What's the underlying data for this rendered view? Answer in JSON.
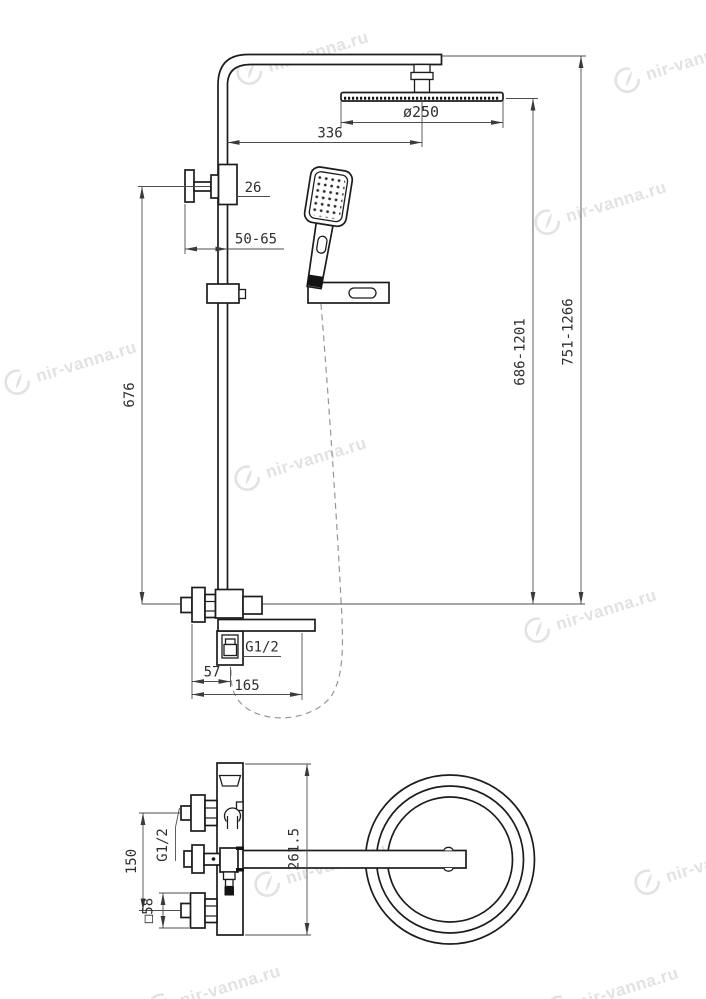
{
  "drawing": {
    "title": "shower-system-dimension-drawing",
    "views": [
      "front-elevation",
      "top-plan"
    ],
    "background": "#ffffff",
    "line_color": "#1c1c1c",
    "dimension_color": "#4d4d4d"
  },
  "dimensions": {
    "overhead_diameter": "ø250",
    "arm_reach": "336",
    "bracket_size": "26",
    "wall_clearance": "50-65",
    "slide_bar_height": "676",
    "overhead_min_max": "686-1201",
    "total_min_max": "751-1266",
    "hose_thread": "G1/2",
    "outlet_offset": "57",
    "spout_reach": "165",
    "top_depth": "261.5",
    "inlet_spacing": "150",
    "inlet_thread": "G1/2",
    "escutcheon_size": "□58"
  },
  "watermark": {
    "text": "nir-vanna.ru",
    "color": "#e2e2e2"
  }
}
